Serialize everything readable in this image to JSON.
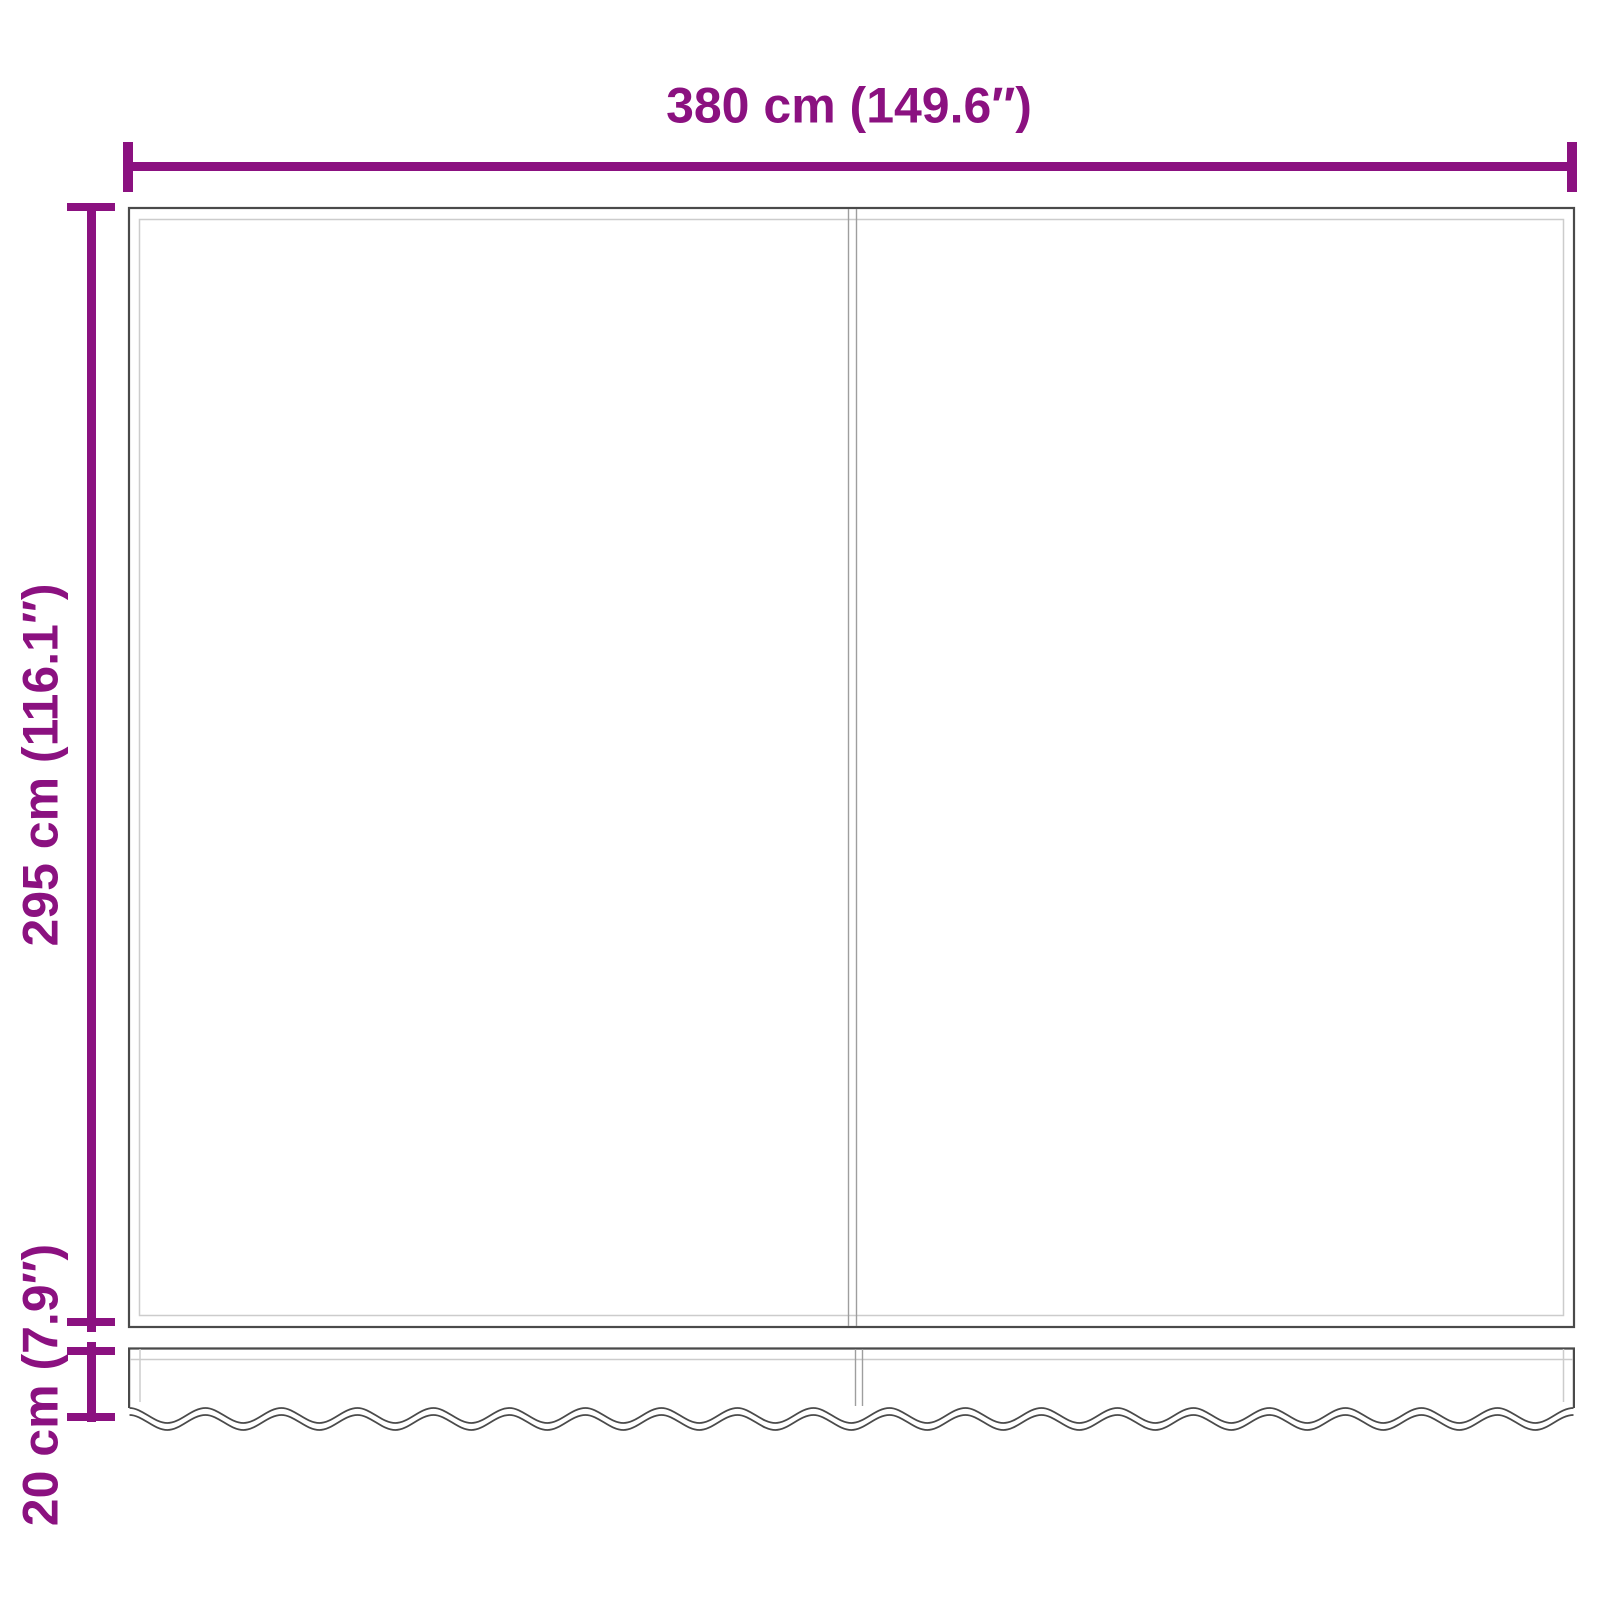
{
  "dimensions": {
    "width": {
      "label": "380 cm (149.6″)"
    },
    "height": {
      "label": "295 cm (116.1″)"
    },
    "valance_height": {
      "label": "20 cm (7.9″)"
    }
  },
  "colors": {
    "accent": "#8B1180",
    "outline": "#4A4A4A",
    "outline-light": "#CCCCCC",
    "seam": "#9E9E9E"
  }
}
